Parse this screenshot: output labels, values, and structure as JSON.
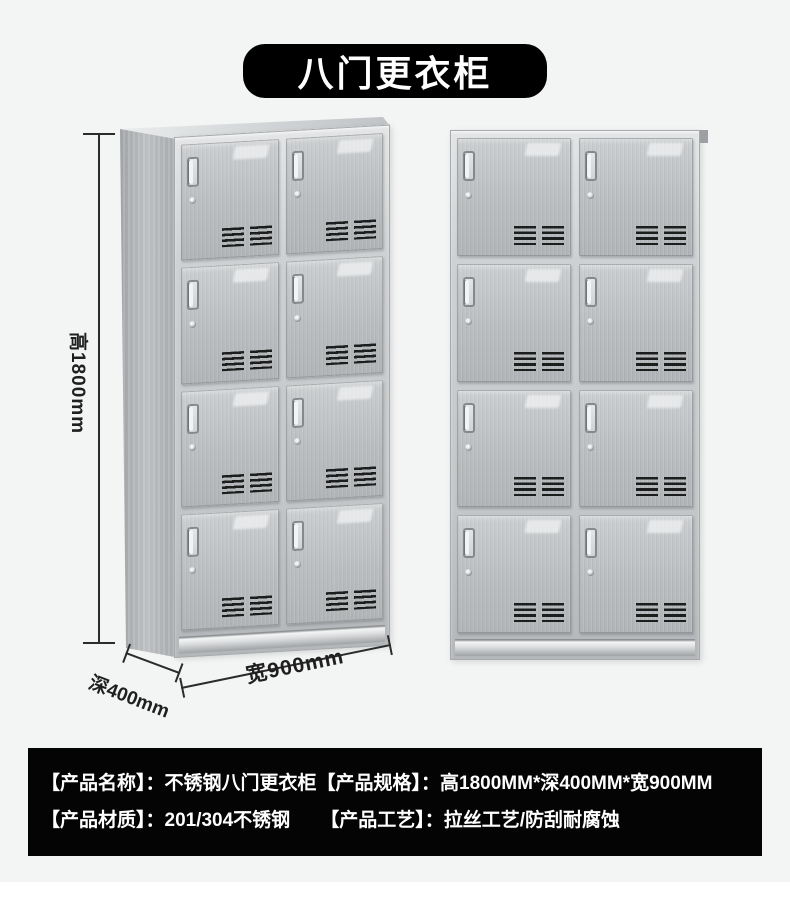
{
  "page": {
    "background": "#f3f4f4",
    "footer_strip_color": "#ffffff"
  },
  "title": {
    "text": "八门更衣柜",
    "bg": "#000000",
    "color": "#ffffff"
  },
  "dimensions": {
    "height_label": "高1800mm",
    "depth_label": "深400mm",
    "width_label": "宽900mm",
    "line_color": "#2b2b2b"
  },
  "cabinet": {
    "rows": 4,
    "cols": 2,
    "door_count": 8,
    "steel_color": "#bcbfc1",
    "frame_color": "#d6d9db",
    "vent_color": "#1c1d1d",
    "icons": [
      "door-handle-icon",
      "keyhole-icon",
      "vent-grille-icon"
    ]
  },
  "info_panel": {
    "bg": "#040404",
    "color": "#ffffff",
    "rows": [
      {
        "segments": [
          "【产品名称】：不锈钢八门更衣柜",
          "【产品规格】：高1800MM*深400MM*宽900MM"
        ]
      },
      {
        "segments": [
          "【产品材质】：201/304不锈钢",
          "【产品工艺】：拉丝工艺/防刮耐腐蚀"
        ]
      }
    ]
  }
}
